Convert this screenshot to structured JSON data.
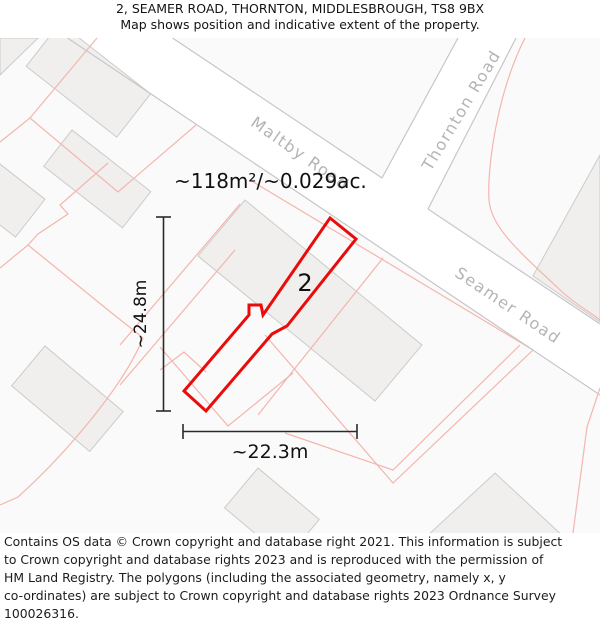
{
  "header": {
    "title": "2, SEAMER ROAD, THORNTON, MIDDLESBROUGH, TS8 9BX",
    "subtitle": "Map shows position and indicative extent of the property."
  },
  "map": {
    "area_label": "~118m²/~0.029ac.",
    "plot_number": "2",
    "dimensions": {
      "vertical": "~24.8m",
      "horizontal": "~22.3m"
    },
    "roads": [
      {
        "name": "Maltby Road"
      },
      {
        "name": "Thornton Road"
      },
      {
        "name": "Seamer Road"
      }
    ],
    "colors": {
      "property_outline": "#ea0b0b",
      "parcel_line": "#f4b5ad",
      "road_edge_line": "#c7c7c7",
      "building_fill": "#f0efee",
      "building_stroke": "#cccbca",
      "block_fill": "#fafafa",
      "road_label_text": "#b4b4b4",
      "dimension_line": "#2a2a2a"
    }
  },
  "footer": {
    "lines": [
      "Contains OS data © Crown copyright and database right 2021. This information is subject",
      "to Crown copyright and database rights 2023 and is reproduced with the permission of",
      "HM Land Registry. The polygons (including the associated geometry, namely x, y",
      "co-ordinates) are subject to Crown copyright and database rights 2023 Ordnance Survey",
      "100026316."
    ]
  }
}
